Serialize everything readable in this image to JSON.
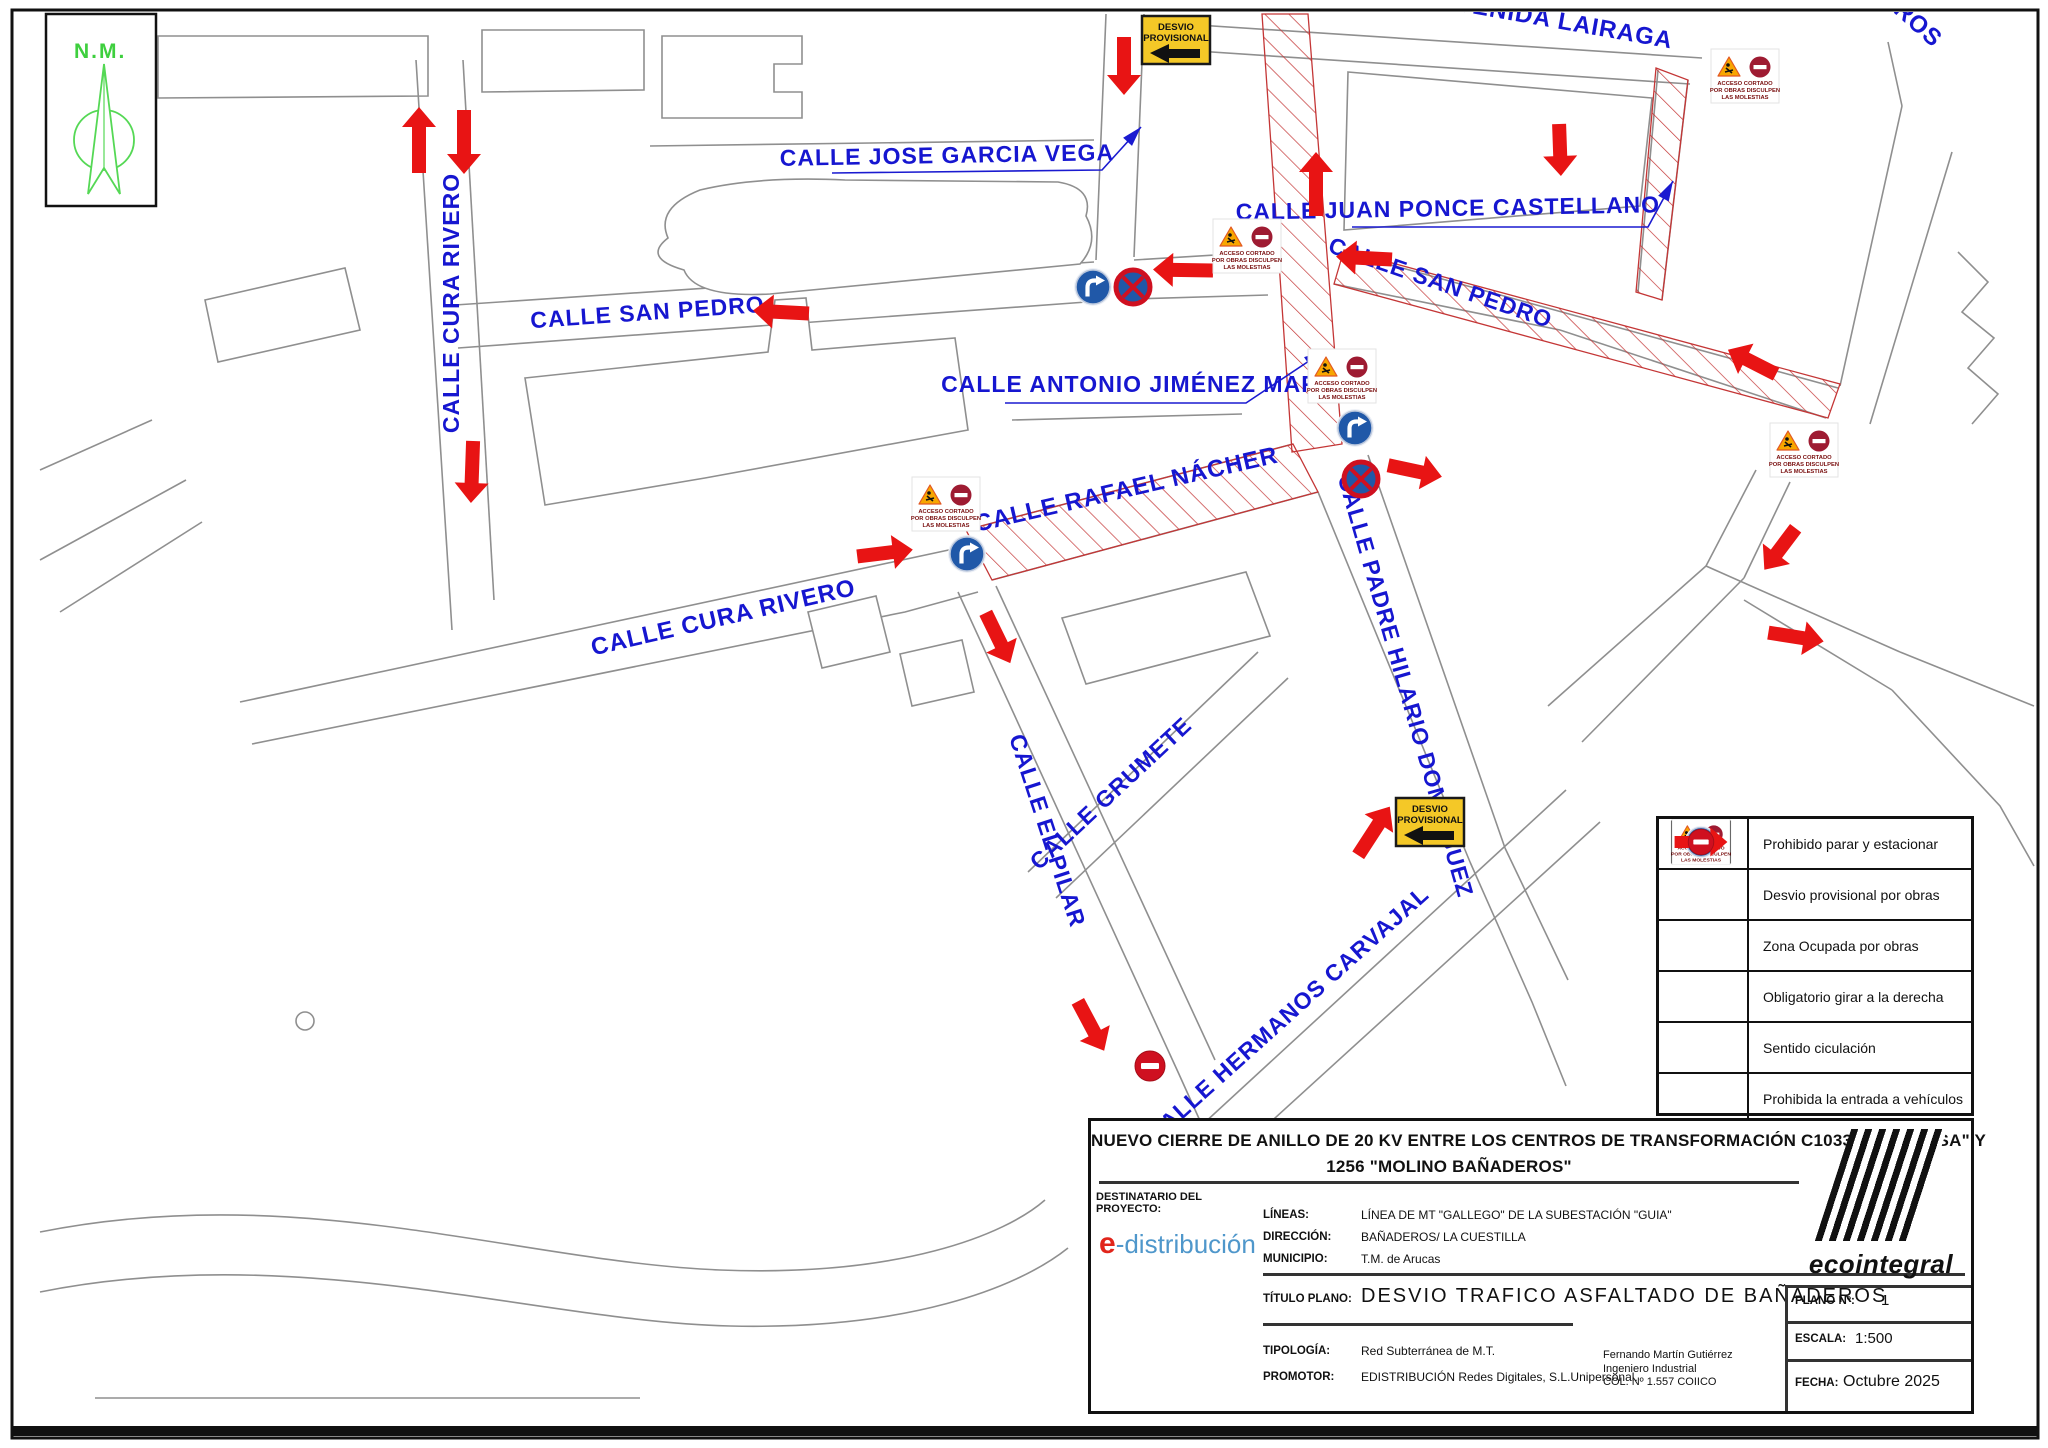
{
  "compass": {
    "label": "N.M."
  },
  "colors": {
    "street_label": "#1616d0",
    "arrow": "#e81414",
    "hatch_line": "#c43636",
    "map_line": "#8f8f8f",
    "sign_blue": "#2058a8",
    "sign_red": "#cf1020",
    "desvio_yellow": "#f4c827",
    "leader_blue": "#1a1ad0"
  },
  "street_labels": [
    {
      "text": "CALLE CURA RIVERO",
      "x": 459,
      "y": 303,
      "rot": -90,
      "size": 23
    },
    {
      "text": "CALLE SAN PEDRO",
      "x": 648,
      "y": 320,
      "rot": -4,
      "size": 23
    },
    {
      "text": "CALLE JOSE GARCIA VEGA",
      "x": 947,
      "y": 163,
      "rot": -1,
      "size": 23
    },
    {
      "text": "CALLE ANTONIO JIMÉNEZ MARTÍN",
      "x": 1150,
      "y": 392,
      "rot": 0,
      "size": 23
    },
    {
      "text": "CALLE RAFAEL NÁCHER",
      "x": 1128,
      "y": 497,
      "rot": -13,
      "size": 24
    },
    {
      "text": "CALLE CURA RIVERO",
      "x": 725,
      "y": 625,
      "rot": -13,
      "size": 24
    },
    {
      "text": "CALLE JUAN PONCE CASTELLANO",
      "x": 1448,
      "y": 216,
      "rot": -1,
      "size": 23
    },
    {
      "text": "CALLE SAN PEDRO",
      "x": 1438,
      "y": 290,
      "rot": 19,
      "size": 23
    },
    {
      "text": "AVENIDA LAIRAGA",
      "x": 1555,
      "y": 28,
      "rot": 10,
      "size": 24
    },
    {
      "text": "ROS",
      "x": 1913,
      "y": 30,
      "rot": 42,
      "size": 24
    },
    {
      "text": "CALLE PADRE HILARIO DOMÍNGUEZ",
      "x": 1398,
      "y": 688,
      "rot": 74,
      "size": 23
    },
    {
      "text": "CALLE EL PILAR",
      "x": 1040,
      "y": 833,
      "rot": 72,
      "size": 23
    },
    {
      "text": "CALLE GRUMETE",
      "x": 1116,
      "y": 799,
      "rot": -43,
      "size": 23
    },
    {
      "text": "CALLE HERMANOS CARVAJAL",
      "x": 1293,
      "y": 1020,
      "rot": -42,
      "size": 23
    }
  ],
  "arrows": [
    {
      "x": 419,
      "y": 140,
      "rot": -90,
      "len": 66
    },
    {
      "x": 464,
      "y": 142,
      "rot": 90,
      "len": 64
    },
    {
      "x": 1124,
      "y": 66,
      "rot": 90,
      "len": 58
    },
    {
      "x": 1316,
      "y": 184,
      "rot": -90,
      "len": 64
    },
    {
      "x": 1560,
      "y": 150,
      "rot": 88,
      "len": 52
    },
    {
      "x": 781,
      "y": 312,
      "rot": 183,
      "len": 56
    },
    {
      "x": 1183,
      "y": 270,
      "rot": 181,
      "len": 60
    },
    {
      "x": 1364,
      "y": 258,
      "rot": 183,
      "len": 56
    },
    {
      "x": 1752,
      "y": 362,
      "rot": 207,
      "len": 54
    },
    {
      "x": 472,
      "y": 472,
      "rot": 92,
      "len": 62
    },
    {
      "x": 885,
      "y": 553,
      "rot": -7,
      "len": 56
    },
    {
      "x": 998,
      "y": 638,
      "rot": 64,
      "len": 56
    },
    {
      "x": 1415,
      "y": 471,
      "rot": 12,
      "len": 55
    },
    {
      "x": 1780,
      "y": 549,
      "rot": 127,
      "len": 52
    },
    {
      "x": 1796,
      "y": 637,
      "rot": 9,
      "len": 56
    },
    {
      "x": 1374,
      "y": 831,
      "rot": -57,
      "len": 58
    },
    {
      "x": 1091,
      "y": 1026,
      "rot": 62,
      "len": 56
    }
  ],
  "leaders": [
    {
      "pts": [
        [
          832,
          173
        ],
        [
          1102,
          170
        ],
        [
          1141,
          127
        ]
      ]
    },
    {
      "pts": [
        [
          1005,
          403
        ],
        [
          1246,
          403
        ],
        [
          1324,
          351
        ]
      ]
    },
    {
      "pts": [
        [
          1352,
          227
        ],
        [
          1648,
          227
        ],
        [
          1673,
          181
        ]
      ]
    }
  ],
  "hatch_zones": [
    "1262,14 1308,14 1342,444 1292,452",
    "966,530 1293,444 1318,492 992,580",
    "1344,250 1840,384 1828,418 1334,284",
    "1656,68 1688,80 1662,300 1636,292"
  ],
  "signs": [
    {
      "type": "desvio",
      "x": 1176,
      "y": 40
    },
    {
      "type": "desvio",
      "x": 1430,
      "y": 822
    },
    {
      "type": "acceso",
      "x": 1247,
      "y": 246
    },
    {
      "type": "acceso",
      "x": 1342,
      "y": 376
    },
    {
      "type": "acceso",
      "x": 946,
      "y": 504
    },
    {
      "type": "acceso",
      "x": 1745,
      "y": 76
    },
    {
      "type": "acceso",
      "x": 1804,
      "y": 450
    },
    {
      "type": "turn",
      "x": 1093,
      "y": 287
    },
    {
      "type": "turn",
      "x": 1355,
      "y": 428
    },
    {
      "type": "turn",
      "x": 967,
      "y": 554
    },
    {
      "type": "nostop",
      "x": 1133,
      "y": 287
    },
    {
      "type": "nostop",
      "x": 1361,
      "y": 479
    },
    {
      "type": "noentry",
      "x": 1150,
      "y": 1066
    }
  ],
  "sign_texts": {
    "desvio_line1": "DESVIO",
    "desvio_line2": "PROVISIONAL",
    "acceso_line1": "ACCESO CORTADO",
    "acceso_line2": "POR OBRAS DISCULPEN",
    "acceso_line3": "LAS MOLESTIAS"
  },
  "legend": {
    "rows": [
      {
        "icon": "nostop",
        "label": "Prohibido parar y estacionar"
      },
      {
        "icon": "desvio",
        "label": "Desvio provisional por obras"
      },
      {
        "icon": "acceso",
        "label": "Zona Ocupada por obras"
      },
      {
        "icon": "turn",
        "label": "Obligatorio girar a la derecha"
      },
      {
        "icon": "arrow",
        "label": "Sentido ciculación"
      },
      {
        "icon": "noentry",
        "label": "Prohibida la entrada a vehículos"
      }
    ]
  },
  "title_block": {
    "project_title_line1": "NUEVO CIERRE DE ANILLO DE 20 KV ENTRE LOS CENTROS DE TRANSFORMACIÓN C103352 \"PROTISA\" Y",
    "project_title_line2": "1256 \"MOLINO BAÑADEROS\"",
    "destinatario_line1": "DESTINATARIO DEL",
    "destinatario_line2": "PROYECTO:",
    "logo_e": "e",
    "logo_rest": "-distribución",
    "lineas_label": "LÍNEAS:",
    "lineas_value": "LÍNEA DE MT \"GALLEGO\" DE LA SUBESTACIÓN \"GUIA\"",
    "direccion_label": "DIRECCIÓN:",
    "direccion_value": "BAÑADEROS/ LA CUESTILLA",
    "municipio_label": "MUNICIPIO:",
    "municipio_value": "T.M. de Arucas",
    "titulo_plano_label": "TÍTULO PLANO:",
    "titulo_plano_value": "DESVIO TRAFICO ASFALTADO DE BAÑADEROS",
    "tipologia_label": "TIPOLOGÍA:",
    "tipologia_value": "Red Subterránea de M.T.",
    "promotor_label": "PROMOTOR:",
    "promotor_value": "EDISTRIBUCIÓN Redes Digitales, S.L.Unipersonal.",
    "engineer_line1": "Fernando Martín Gutiérrez",
    "engineer_line2": "Ingeniero Industrial",
    "engineer_line3": "COL. Nº 1.557 COIICO",
    "plano_label": "PLANO Nº:",
    "plano_value": "1",
    "escala_label": "ESCALA:",
    "escala_value": "1:500",
    "fecha_label": "FECHA:",
    "fecha_value": "Octubre 2025",
    "brand": "ecointegral"
  }
}
